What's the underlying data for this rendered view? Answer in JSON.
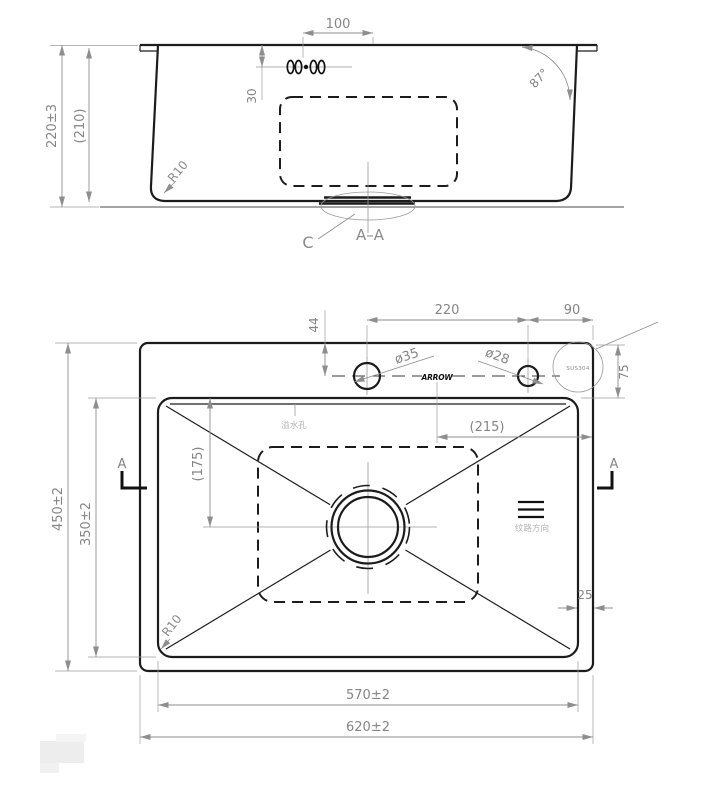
{
  "drawing": {
    "section_view": {
      "dim_width_100": "100",
      "dim_depth_30": "30",
      "dim_height": "220±3",
      "dim_height_ref": "(210)",
      "dim_corner_radius": "R10",
      "dim_wall_angle": "87°",
      "detail_label": "C",
      "section_label": "A–A"
    },
    "plan_view": {
      "dim_hole_offset": "44",
      "dim_hole_spacing": "220",
      "dim_hole_to_edge": "90",
      "dim_deck_depth": "75",
      "dim_faucet_hole": "ø35",
      "dim_soap_hole": "ø28",
      "dim_ref_width": "(215)",
      "dim_ref_height": "(175)",
      "dim_bowl_depth": "350±2",
      "dim_overall_depth": "450±2",
      "dim_bowl_width": "570±2",
      "dim_overall_width": "620±2",
      "dim_corner_radius": "R10",
      "dim_edge_gap": "25",
      "label_material": "SUS304",
      "label_brand": "ARROW",
      "label_overflow_hole": "溢水孔",
      "label_grain_direction": "纹路方向",
      "label_section_left": "A",
      "label_section_right": "A"
    },
    "colors": {
      "line": "#1c1c1c",
      "dimension": "#8e8e8e",
      "background": "#ffffff"
    }
  }
}
